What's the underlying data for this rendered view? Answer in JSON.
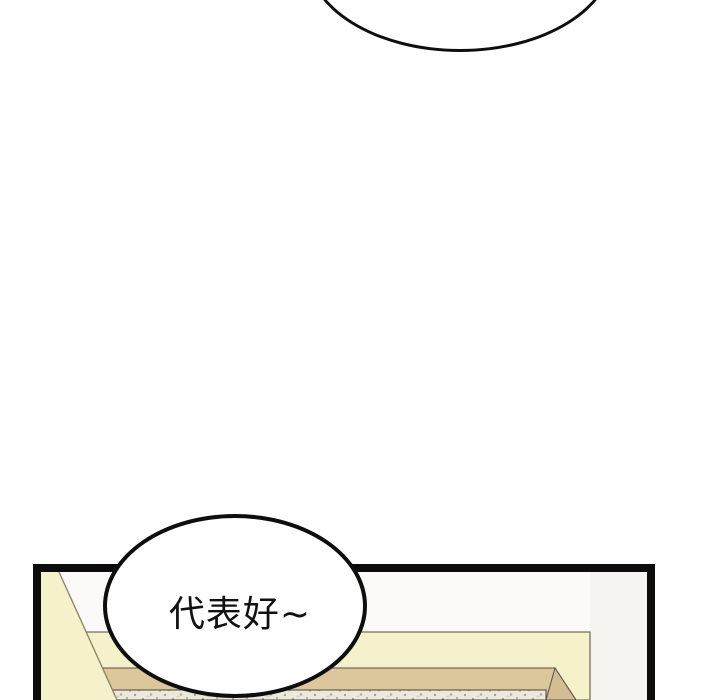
{
  "panel": {
    "bubble_text": "代表好~"
  },
  "speech_bubbles": [
    {
      "id": "top-partial",
      "text": ""
    },
    {
      "id": "main",
      "text": "代表好~"
    }
  ],
  "colors": {
    "page_bg": "#ffffff",
    "bubble_fill": "#ffffff",
    "bubble_outline": "#0e0e0e",
    "panel_border": "#0c0c0c",
    "wall_yellow": "#f5f1ca",
    "sofa_tan": "#dcc79d",
    "sofa_tan_dark": "#d3be93",
    "texture_base": "#ece8db",
    "text_color": "#111111"
  }
}
